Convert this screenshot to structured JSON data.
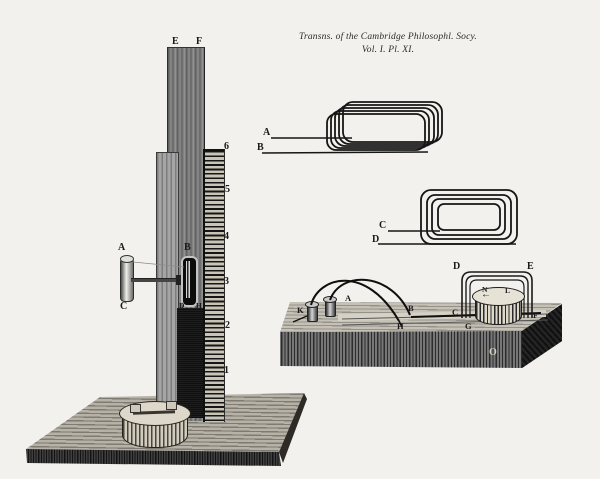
{
  "plate": {
    "title_line1": "Transns. of the Cambridge Philosophl. Socy.",
    "title_line2": "Vol. I. Pl. XI.",
    "paper_color": "#f2f1ed",
    "ink_color": "#1a1a1a"
  },
  "stand": {
    "post_top_left_label": "E",
    "post_top_right_label": "F",
    "magnet_top_label": "A",
    "magnet_bottom_label": "C",
    "slider_label": "B",
    "slider_foot_left_label": "D",
    "slider_foot_right_label": "H",
    "scale_numbers": [
      "6",
      "5",
      "4",
      "3",
      "2",
      "1"
    ]
  },
  "flat_coil_ab": {
    "lead_upper_label": "A",
    "lead_lower_label": "B"
  },
  "flat_coil_cd": {
    "lead_upper_label": "C",
    "lead_lower_label": "D"
  },
  "block_apparatus": {
    "post_left_label": "K",
    "post_right_label": "A",
    "wire_end_label": "B",
    "wire_drop_label": "H",
    "groove_label_c": "C",
    "groove_label_g": "G",
    "frame_left_label": "D",
    "frame_right_label": "E",
    "drum_top_left_label": "N",
    "drum_top_right_label": "L",
    "drum_side_label": "F",
    "front_face_label": "O",
    "drum_arrow": "←"
  }
}
